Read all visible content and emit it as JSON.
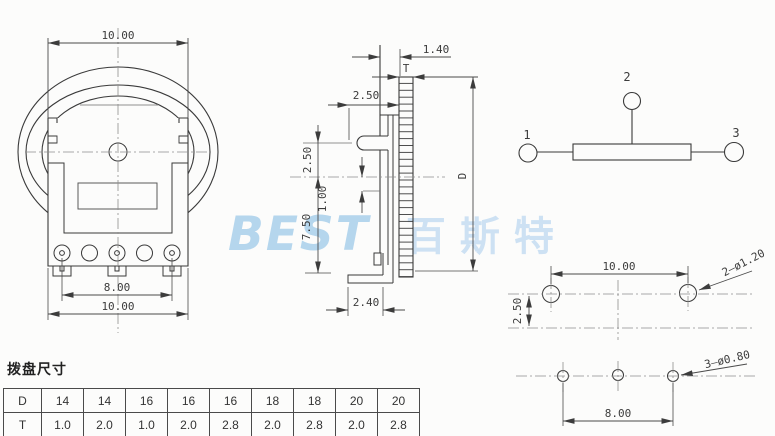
{
  "front": {
    "dim_top": "10.00",
    "dim_pins": "8.00",
    "dim_overall": "10.00"
  },
  "side": {
    "dim_gap": "1.40",
    "label_thickness": "T",
    "dim_hub": "2.50",
    "dim_offset": "2.50",
    "dim_wiper": "1.00",
    "dim_depth": "7.50",
    "dim_foot": "2.40",
    "label_diameter": "D"
  },
  "schematic": {
    "pin1": "1",
    "pin2": "2",
    "pin3": "3"
  },
  "pcb_top": {
    "dim_span": "10.00",
    "dim_row_gap": "2.50",
    "holes_note": "2—ø1.20"
  },
  "pcb_bottom": {
    "dim_span": "8.00",
    "holes_note": "3—ø0.80"
  },
  "table": {
    "title": "拨盘尺寸",
    "row_d": {
      "header": "D",
      "values": [
        "14",
        "14",
        "16",
        "16",
        "16",
        "18",
        "18",
        "20",
        "20"
      ]
    },
    "row_t": {
      "header": "T",
      "values": [
        "1.0",
        "2.0",
        "1.0",
        "2.0",
        "2.8",
        "2.0",
        "2.8",
        "2.0",
        "2.8"
      ]
    }
  },
  "watermark": {
    "latin": "BEST",
    "cjk": "百斯特"
  },
  "colors": {
    "line": "#3a3a3a",
    "centerline": "#8d8d8d",
    "watermark_latin": "#aed2ec",
    "watermark_cjk": "#c9dff3"
  }
}
